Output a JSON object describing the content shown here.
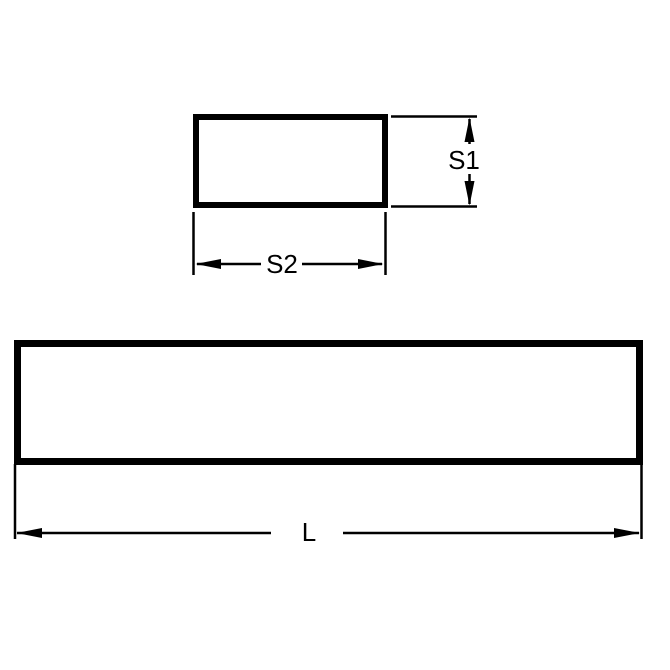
{
  "colors": {
    "background": "#ffffff",
    "line": "#000000",
    "label_text": "#000000"
  },
  "views": {
    "cross_section": {
      "height_dimension": {
        "label": "S1"
      },
      "width_dimension": {
        "label": "S2"
      }
    },
    "side": {
      "length_dimension": {
        "label": "L"
      }
    }
  }
}
